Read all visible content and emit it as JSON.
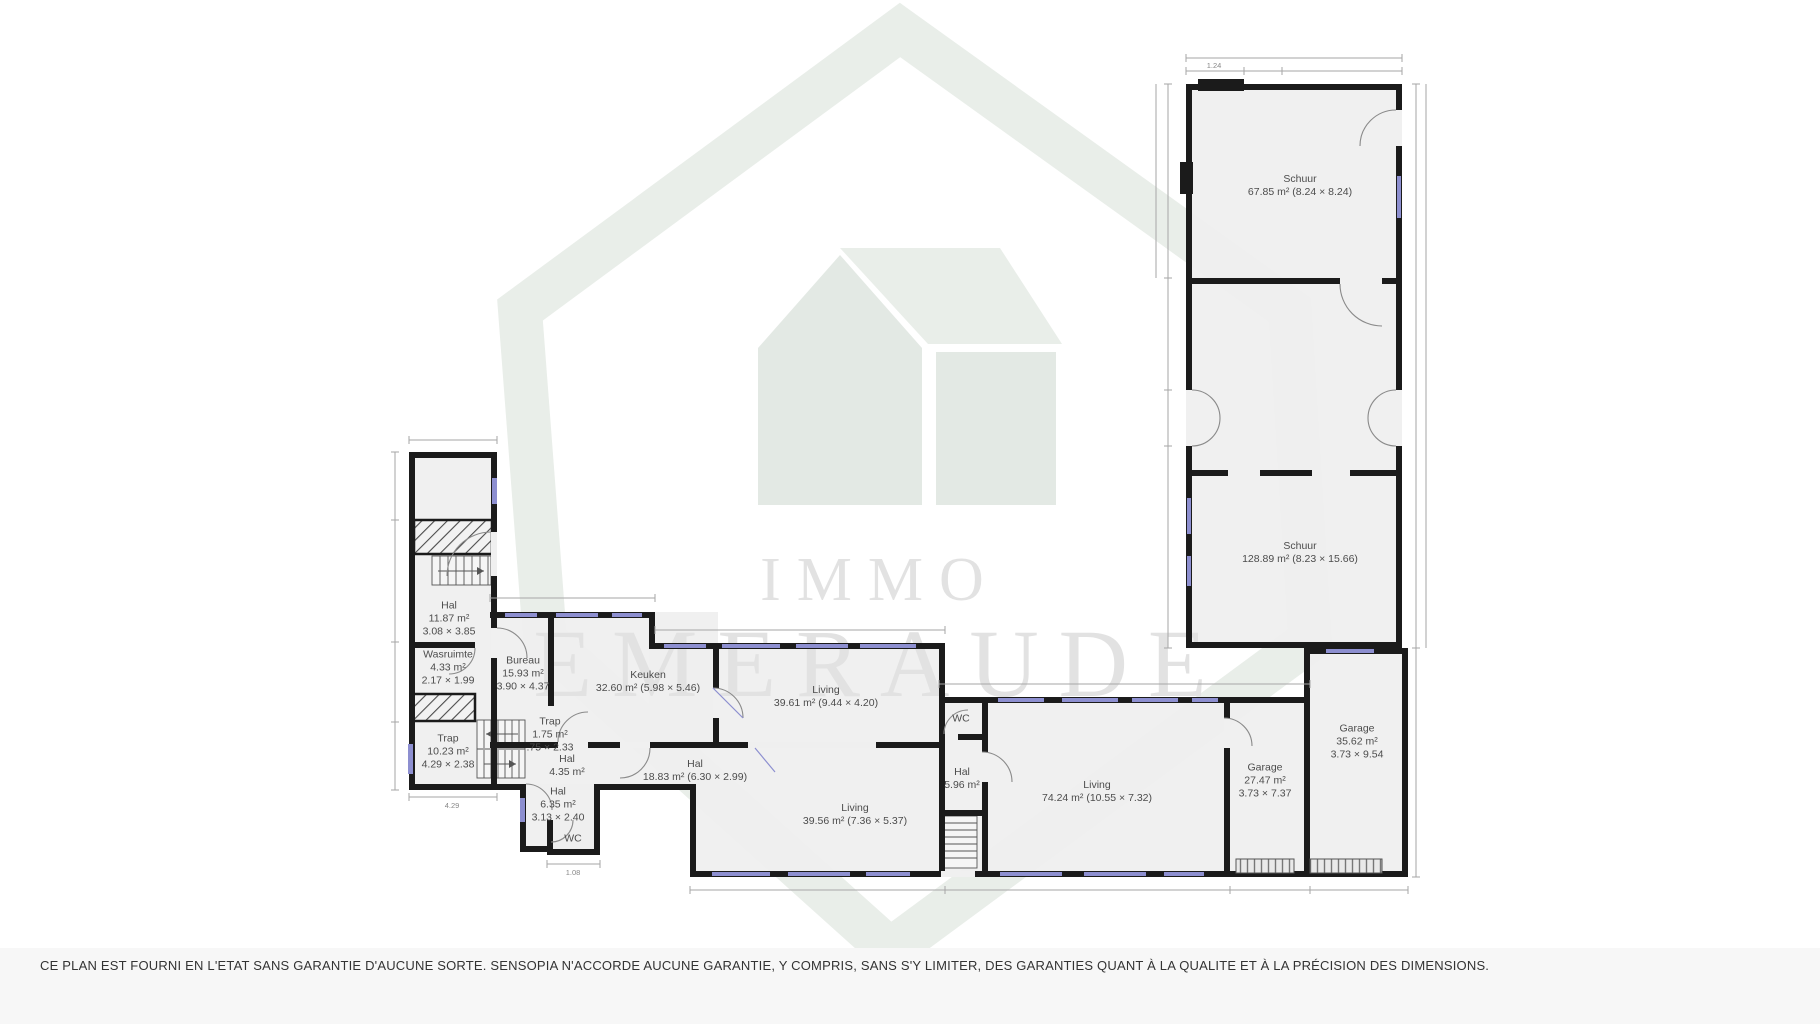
{
  "watermark": {
    "brand_line1": "IMMO",
    "brand_line2": "EMERAUDE"
  },
  "disclaimer": "CE PLAN EST FOURNI EN L'ETAT SANS GARANTIE D'AUCUNE SORTE. SENSOPIA N'ACCORDE AUCUNE GARANTIE, Y COMPRIS, SANS S'Y LIMITER, DES GARANTIES QUANT À LA QUALITE ET À LA PRÉCISION DES DIMENSIONS.",
  "colors": {
    "wall": "#1b1b1b",
    "room_fill": "#efefef",
    "watermark_green": "#e9eee9",
    "watermark_text": "#e2e2e2",
    "window_accent": "#8d8fd0",
    "dimension_line": "#a0a0a0"
  },
  "rooms": {
    "schuur_top": {
      "name": "Schuur",
      "area": "67.85 m² (8.24 × 8.24)"
    },
    "schuur_main": {
      "name": "Schuur",
      "area": "128.89 m² (8.23 × 15.66)"
    },
    "garage_right": {
      "name": "Garage",
      "area": "35.62 m²",
      "dims": "3.73 × 9.54"
    },
    "garage_left": {
      "name": "Garage",
      "area": "27.47 m²",
      "dims": "3.73 × 7.37"
    },
    "living_74": {
      "name": "Living",
      "area": "74.24 m² (10.55 × 7.32)"
    },
    "hal_5": {
      "name": "Hal",
      "area": "5.96 m²"
    },
    "wc_right": {
      "name": "WC"
    },
    "living_39a": {
      "name": "Living",
      "area": "39.61 m² (9.44 × 4.20)"
    },
    "living_39b": {
      "name": "Living",
      "area": "39.56 m² (7.36 × 5.37)"
    },
    "hal_18": {
      "name": "Hal",
      "area": "18.83 m² (6.30 × 2.99)"
    },
    "keuken": {
      "name": "Keuken",
      "area": "32.60 m² (5.98 × 5.46)"
    },
    "bureau": {
      "name": "Bureau",
      "area": "15.93 m²",
      "dims": "3.90 × 4.37"
    },
    "hal_11": {
      "name": "Hal",
      "area": "11.87 m²",
      "dims": "3.08 × 3.85"
    },
    "wasruimte": {
      "name": "Wasruimte",
      "area": "4.33 m²",
      "dims": "2.17 × 1.99"
    },
    "trap_10": {
      "name": "Trap",
      "area": "10.23 m²",
      "dims": "4.29 × 2.38"
    },
    "trap_1": {
      "name": "Trap",
      "area": "1.75 m²",
      "dims": ".75 × 2.33"
    },
    "hal_4": {
      "name": "Hal",
      "area": "4.35 m²"
    },
    "hal_6": {
      "name": "Hal",
      "area": "6.35 m²",
      "dims": "3.13 × 2.40"
    },
    "wc_left": {
      "name": "WC"
    }
  },
  "dimension_labels": {
    "schuur_top": "1.24",
    "trap_width": "4.29",
    "wc_bottom": "1.08"
  }
}
